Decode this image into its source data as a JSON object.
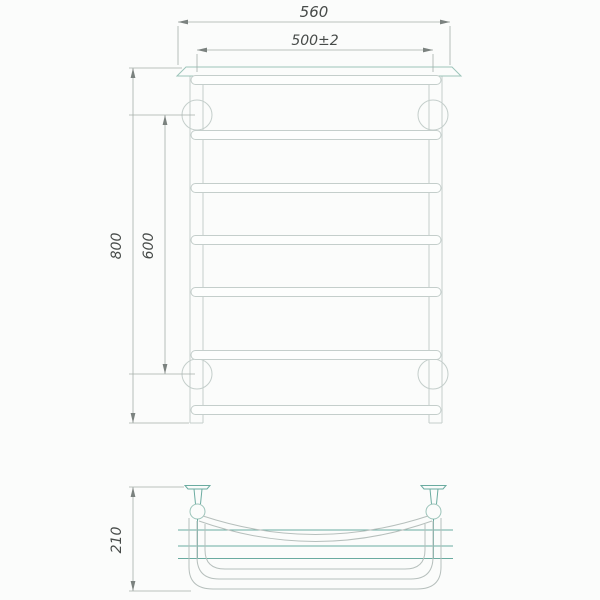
{
  "drawing": {
    "dimensions": {
      "top_width": "560",
      "rail_width": "500±2",
      "total_height": "800",
      "bracket_spacing": "600",
      "depth": "210"
    },
    "colors": {
      "background": "#fbfcfb",
      "line_gray": "#c4cecb",
      "line_teal_light": "#9cc4ba",
      "line_teal": "#6aaba0",
      "curve_gray": "#b6bfbc",
      "dim_line": "#a6aeab",
      "dim_text": "#474b49",
      "arrow": "#7b827f"
    }
  }
}
